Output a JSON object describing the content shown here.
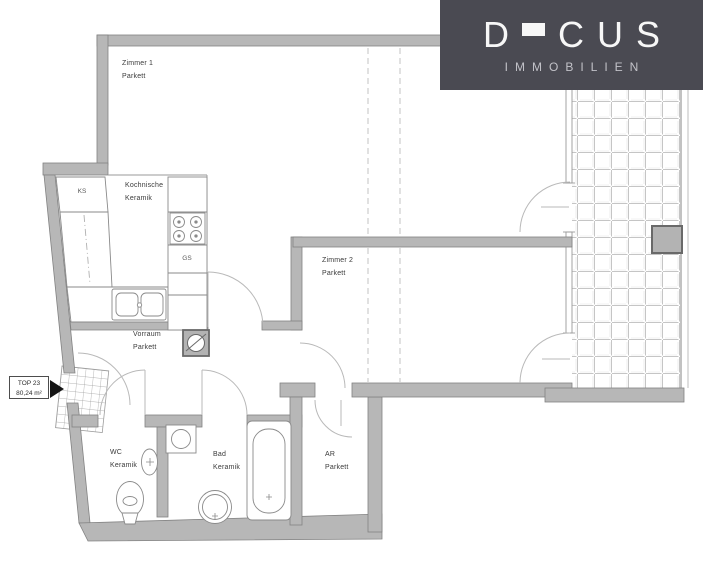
{
  "logo": {
    "letter_d": "D",
    "letter_c": "C",
    "letter_u": "U",
    "letter_s": "S",
    "subtitle": "IMMOBILIEN",
    "bg_color": "#4a4a52",
    "brand_color": "#f7f7f7",
    "subtitle_color": "#c2c2c8"
  },
  "unit_badge": {
    "top_line": "TOP 23",
    "area_line": "80,24 m²"
  },
  "rooms": {
    "zimmer1": {
      "name": "Zimmer 1",
      "floor": "Parkett"
    },
    "kochnische": {
      "name": "Kochnische",
      "floor": "Keramik"
    },
    "zimmer2": {
      "name": "Zimmer 2",
      "floor": "Parkett"
    },
    "vorraum": {
      "name": "Vorraum",
      "floor": "Parkett"
    },
    "wc": {
      "name": "WC",
      "floor": "Keramik"
    },
    "bad": {
      "name": "Bad",
      "floor": "Keramik"
    },
    "ar": {
      "name": "AR",
      "floor": "Parkett"
    }
  },
  "appliances": {
    "fridge_label": "KS",
    "dishwasher_label": "GS"
  },
  "colors": {
    "wall_fill": "#b7b7b7",
    "wall_stroke": "#828282",
    "fixture_line": "#8a8a8a",
    "door_arc": "#b9b9b9",
    "tile_line": "#c5c5c5",
    "marker_black": "#151515"
  }
}
